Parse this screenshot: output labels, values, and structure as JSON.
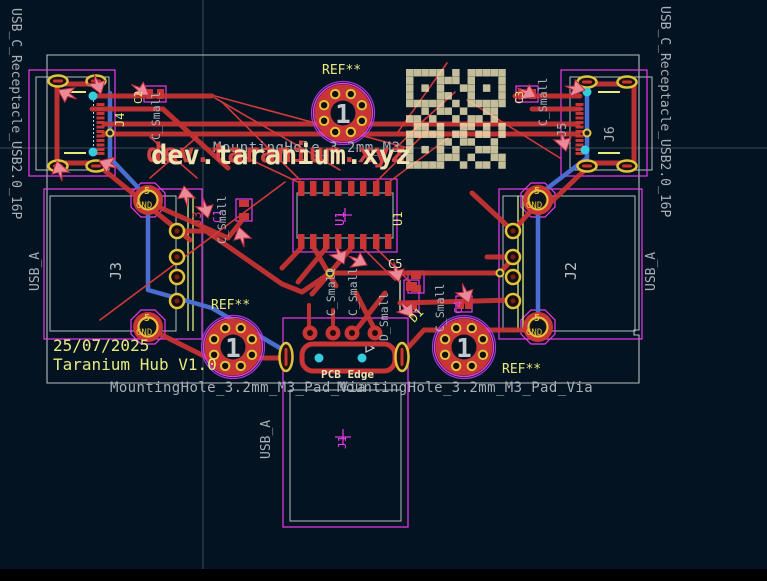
{
  "colors": {
    "bg": "#041321",
    "copper_front": "#c93434",
    "copper_back": "#4a6ed0",
    "silk_front": "#efe3b4",
    "silk_back": "#d04040",
    "gold": "#e2c13f",
    "magenta": "#ee3bee",
    "violet": "#9b3fd4",
    "fab_gray": "#b9bdc1",
    "text_gray": "#aab0b6",
    "yellow": "#e9e97e",
    "cyan": "#35cddd",
    "drc_fill": "#ea8a99",
    "drc_stroke": "#c22f45",
    "axis": "#6e7a85",
    "hole_number_gray": "#c3c8cd"
  },
  "labels": {
    "title": "dev.taranium.xyz",
    "mounting_partial": "MountingHole_3.2mm_M3_",
    "mounting_full": "MountingHole_3.2mm_M3_Pad_Via",
    "ref": "REF**",
    "hole_number": "1",
    "date": "25/07/2025",
    "version": "Taranium Hub V1.0",
    "pcb_edge": "PCB Edge",
    "usb_a": "USB_A",
    "usb_c_name": "USB_C_Receptacle_USB2.0_16P",
    "c_small": "C_Small",
    "d_small": "D_Small",
    "pad5": "5",
    "gnd": "GND",
    "j1": "J1",
    "j2": "J2",
    "j3": "J3",
    "j4": "J4",
    "j5": "J5",
    "j6": "J6",
    "u1": "U1",
    "c1": "C1",
    "c2": "C2",
    "c3": "C3",
    "c4": "C4",
    "c5": "C5",
    "d1": "D1"
  },
  "qr_pattern": [
    "1111101011111",
    "1000111010001",
    "1010100110101",
    "1000110010001",
    "1111101011111",
    "0010110100110",
    "1101001011010",
    "0110100110101",
    "1111101101101",
    "1000110110010",
    "1010101001110",
    "1000111010011",
    "1111100101101"
  ]
}
